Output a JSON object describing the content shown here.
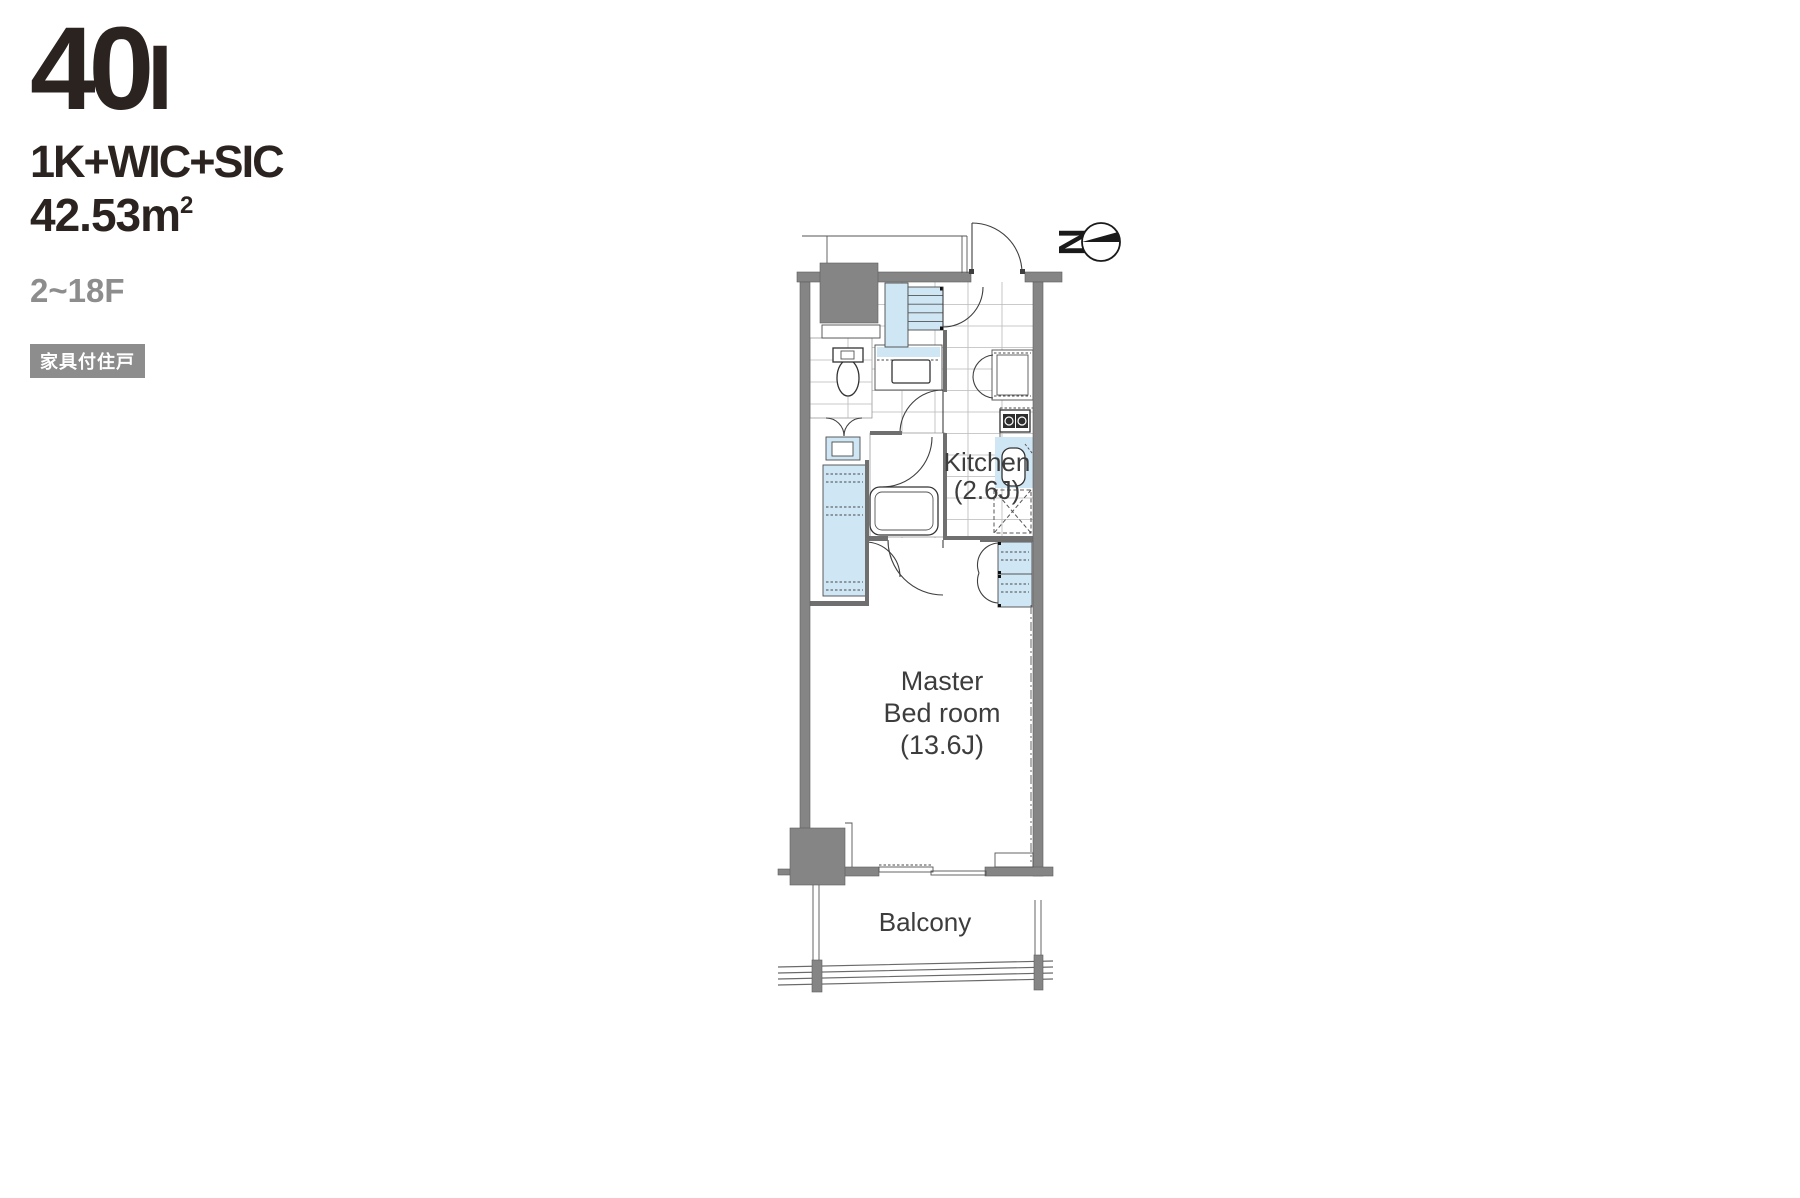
{
  "header": {
    "unit_main": "40",
    "unit_suffix": "I",
    "layout_type": "1K+WIC+SIC",
    "area_value": "42.53m",
    "area_sup": "2",
    "floors": "2~18F",
    "badge": "家具付住戸"
  },
  "plan": {
    "kitchen_label": "Kitchen",
    "kitchen_size": "(2.6J)",
    "bedroom_line1": "Master",
    "bedroom_line2": "Bed room",
    "bedroom_size": "(13.6J)",
    "balcony_label": "Balcony",
    "compass_letter": "N"
  },
  "colors": {
    "accent_blue": "#cfe6f4",
    "wall_gray": "#858585",
    "ink": "#2b2320",
    "muted": "#8d8d8d",
    "line": "#3f3f3f"
  }
}
